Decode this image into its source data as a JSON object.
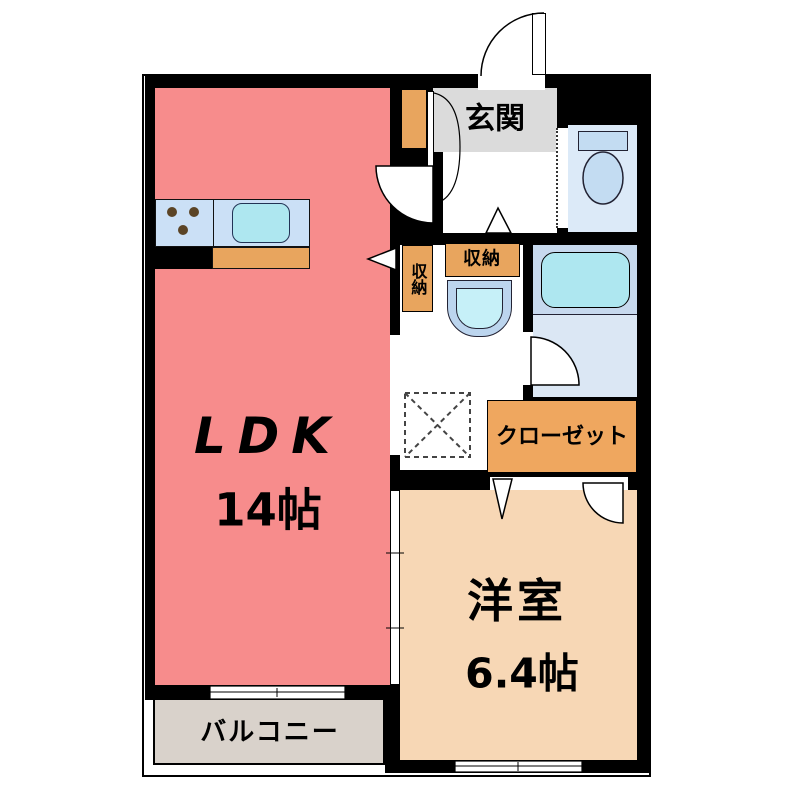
{
  "plan": {
    "type": "floor-plan",
    "rooms": {
      "ldk": {
        "label": "LDK",
        "size": "14帖"
      },
      "western_room": {
        "label": "洋室",
        "size": "6.4帖"
      },
      "entrance": {
        "label": "玄関"
      },
      "balcony": {
        "label": "バルコニー"
      },
      "closet": {
        "label": "クローゼット"
      },
      "storage_vertical": {
        "label": "収納"
      },
      "storage_horizontal": {
        "label": "収納"
      }
    },
    "colors": {
      "wall": "#000000",
      "ldk_fill": "#F78C8C",
      "western_room_fill": "#F7D7B5",
      "entrance_fill": "#DBDBDB",
      "balcony_fill": "#D9D2CB",
      "storage_fill": "#E8A55E",
      "closet_fill": "#EFA75F",
      "counter_fill": "#CBE0F6",
      "sink_fill": "#AEE7F0",
      "toilet_room_fill": "#DCEAF8",
      "bath_fill": "#C7D9EE",
      "tub_fill": "#AEE7F0",
      "basin_fill": "#BCD5EE"
    }
  }
}
